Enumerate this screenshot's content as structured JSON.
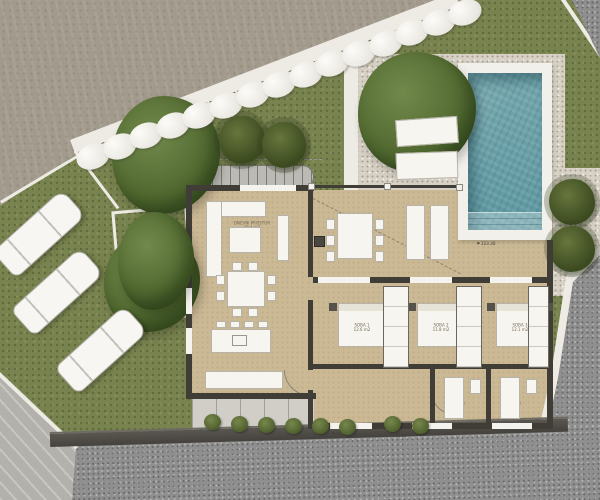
{
  "palette": {
    "grass": "#79834f",
    "dirt_road": "#a29a8c",
    "gravel": "#d7d1c5",
    "house_floor": "#cbb995",
    "walls": "#403d37",
    "pool_water": "#6ea6ab",
    "pool_deck": "#f1f0eb",
    "asphalt": "#8f8f8f",
    "retaining_wall": "#4e4b45",
    "foliage": "#50682f",
    "white_elements": "#f6f5f0"
  },
  "rooms": {
    "living": {
      "name": "DNEVNI PROSTOR",
      "area": "28.4 m2"
    },
    "dining": {
      "name": "JEDILNICA",
      "area": "14.8 m2"
    },
    "kitchen": {
      "name": "KUHINJA",
      "area": "12.2 m2"
    }
  },
  "bedrooms": [
    {
      "name": "SOBA 1",
      "area": "12.6 m2"
    },
    {
      "name": "SOBA 2",
      "area": "11.8 m2"
    },
    {
      "name": "SOBA 3",
      "area": "12.1 m2"
    }
  ],
  "baths": [
    {
      "name": "KOP. 1",
      "area": "4.2 m2"
    },
    {
      "name": "KOP. 2",
      "area": "3.8 m2"
    }
  ],
  "markers": {
    "pool_level": "123.30",
    "entry_level": "±0.00",
    "path_level": "+123.30"
  }
}
